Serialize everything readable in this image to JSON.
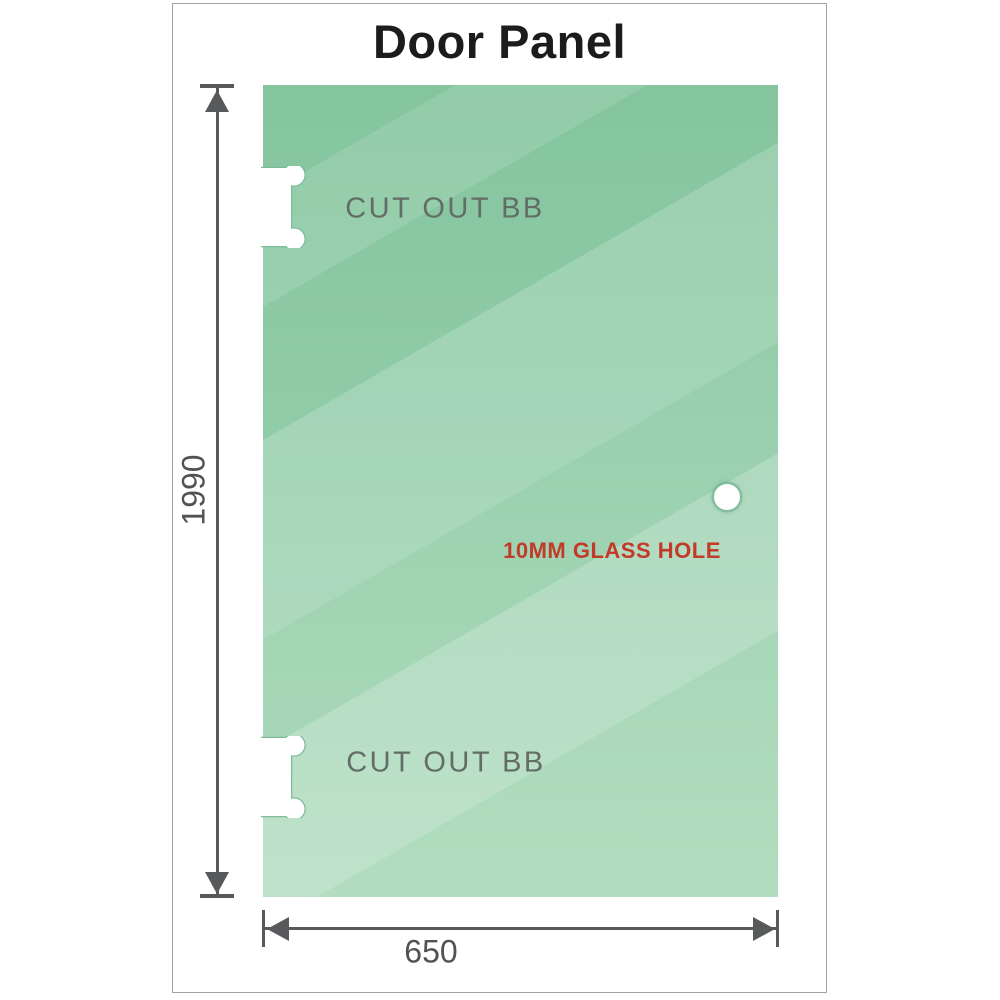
{
  "title": "Door Panel",
  "diagram": {
    "height_dimension": "1990",
    "width_dimension": "650",
    "cutout_top_label": "CUT OUT BB",
    "cutout_bottom_label": "CUT OUT BB",
    "hole_label": "10MM GLASS HOLE"
  },
  "colors": {
    "glass_green_top": "#84c59e",
    "glass_green_bottom": "#a8d8b7",
    "dimension_gray": "#58595b",
    "cutout_text_gray": "#636d67",
    "hole_text_red": "#c23a28",
    "frame_border_gray": "#a2a2a2",
    "title_black": "#1c1c1c",
    "background_white": "#ffffff"
  }
}
